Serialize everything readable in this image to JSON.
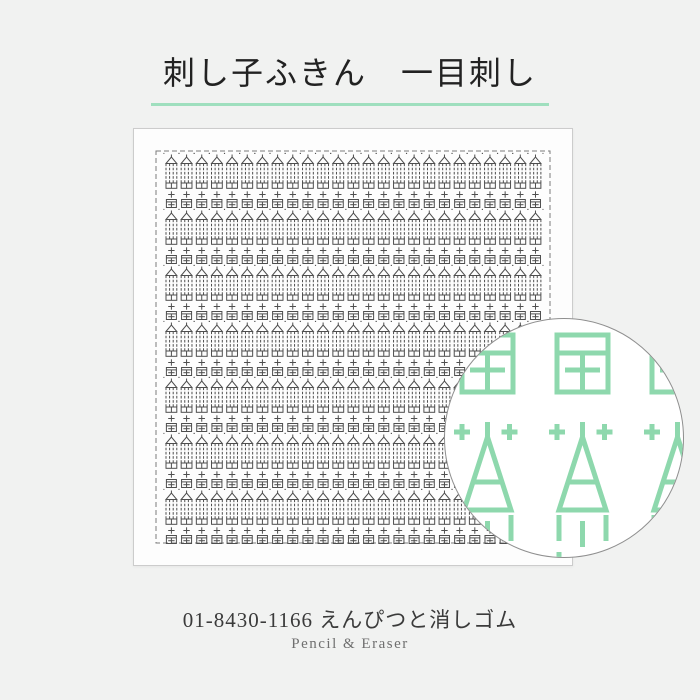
{
  "page": {
    "background_color": "#f1f2f1"
  },
  "header": {
    "title": "刺し子ふきん　一目刺し",
    "text_color": "#222222",
    "underline_color": "#9fdfbe"
  },
  "cloth": {
    "background_color": "#fdfdfd",
    "border_color": "#cccccc",
    "pattern": {
      "columns": 25,
      "rows": 7,
      "stitch_color": "#4e4e4e",
      "dashed_border_color": "#7a7a7a",
      "motifs": [
        "pencil",
        "plus-stitch",
        "eraser"
      ]
    }
  },
  "magnifier": {
    "background_color": "#ffffff",
    "border_color": "#8f8f8f",
    "thread_color": "#8ed8ad",
    "eraser_count": 3,
    "plus_count": 5,
    "pencil_count": 3,
    "motifs": [
      "eraser",
      "plus-stitch",
      "pencil"
    ]
  },
  "footer": {
    "product_code": "01-8430-1166",
    "product_name_jp": "えんぴつと消しゴム",
    "product_name_en": "Pencil & Eraser",
    "code_color": "#3b3b3b",
    "en_color": "#6f6f6f"
  }
}
